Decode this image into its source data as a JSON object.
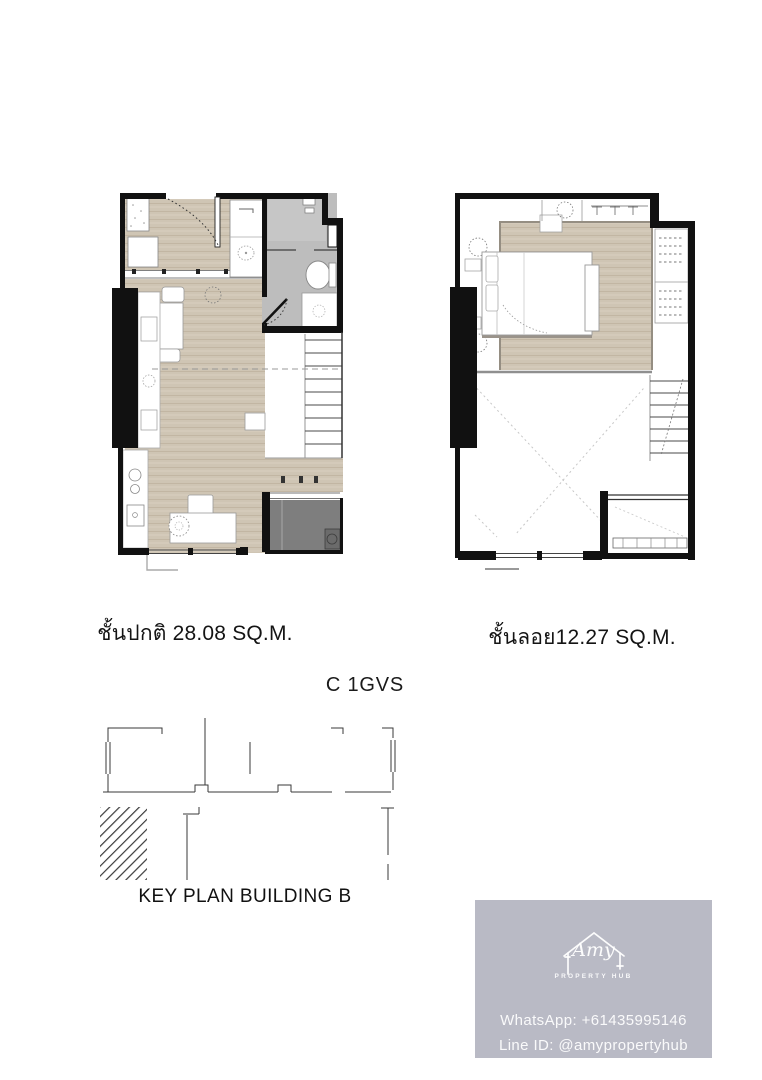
{
  "page": {
    "background": "#ffffff"
  },
  "plans": {
    "ground_caption": "ชั้นปกติ 28.08 SQ.M.",
    "mezzanine_caption": "ชั้นลอย12.27 SQ.M.",
    "unit_type": "C 1GVS",
    "key_plan_label": "KEY PLAN BUILDING B"
  },
  "branding": {
    "logo_name": "Amy",
    "logo_subtitle": "PROPERTY HUB",
    "whatsapp": "WhatsApp: +61435995146",
    "line_id": "Line ID: @amypropertyhub",
    "logo_icon": "house-outline-icon",
    "card_color": "#b9bac5",
    "text_color": "#ffffff"
  },
  "colors": {
    "wall": "#111111",
    "wood_floor": "#cfc5b4",
    "bathroom_floor": "#bdbdbd",
    "balcony_floor": "#7e7e7e",
    "furniture": "#ffffff"
  }
}
